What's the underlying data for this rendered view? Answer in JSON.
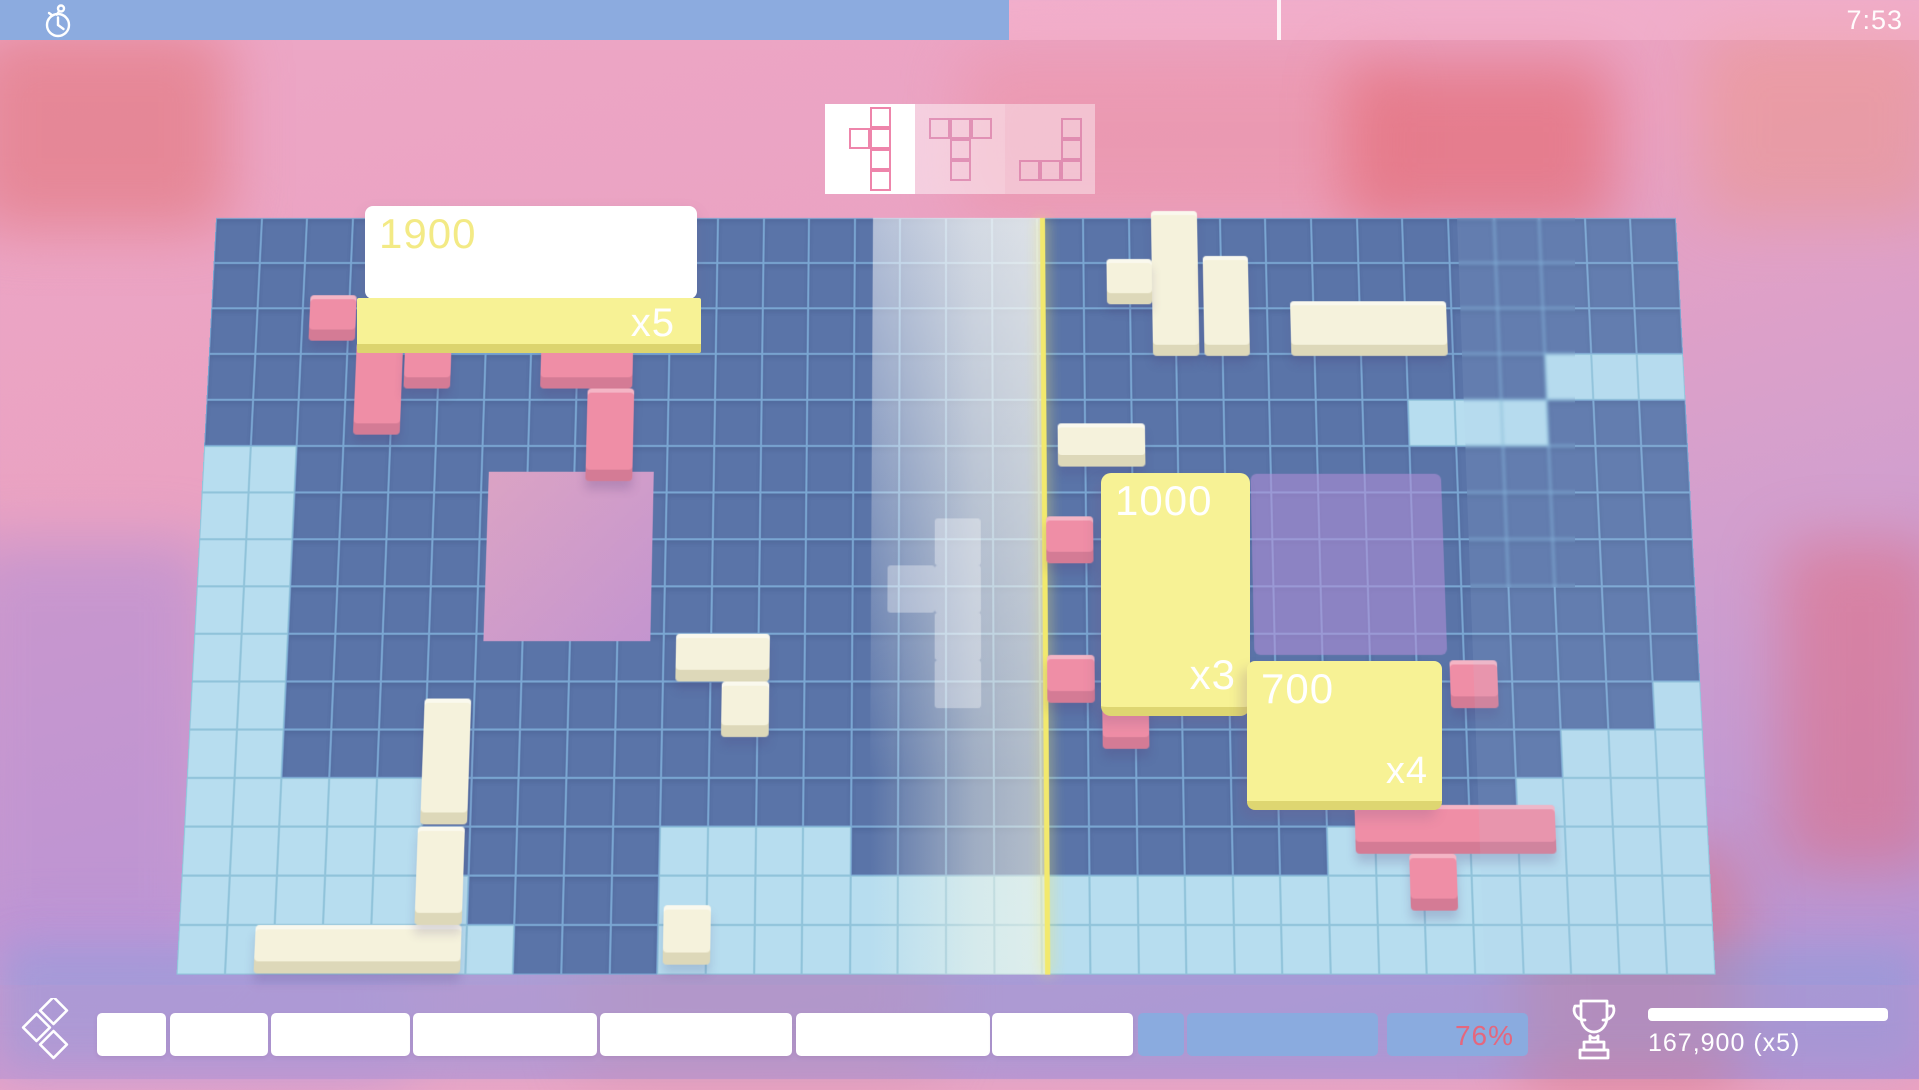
{
  "hud": {
    "time": "7:53",
    "timer": {
      "fill_px": 1009,
      "marker_px": 1277
    }
  },
  "queue": {
    "slots": [
      {
        "id": "current",
        "active": true,
        "piece": "y-pentomino",
        "cells": [
          [
            1,
            0
          ],
          [
            0,
            1
          ],
          [
            1,
            1
          ],
          [
            1,
            2
          ],
          [
            1,
            3
          ]
        ]
      },
      {
        "id": "next-1",
        "active": false,
        "piece": "t-pentomino",
        "cells": [
          [
            0,
            0
          ],
          [
            1,
            0
          ],
          [
            2,
            0
          ],
          [
            1,
            1
          ],
          [
            1,
            2
          ]
        ]
      },
      {
        "id": "next-2",
        "active": false,
        "piece": "j-pentomino",
        "cells": [
          [
            2,
            0
          ],
          [
            2,
            1
          ],
          [
            0,
            2
          ],
          [
            1,
            2
          ],
          [
            2,
            2
          ]
        ]
      }
    ]
  },
  "board": {
    "cols": 32,
    "rows": 16,
    "colors": {
      "dark": "#5a74a8",
      "dark_border": "#7aa6d2",
      "light": "#b7ddef",
      "light_border": "#90c3da",
      "hole": "#cf9ccb",
      "zone": "rgba(178,143,215,0.58)",
      "divider": "#f2e96d",
      "pink": "#ef8ea6",
      "cream": "#f5f2dc",
      "ghost": "rgba(255,255,255,0.34)"
    },
    "light_runs": [
      [
        3,
        29,
        31
      ],
      [
        4,
        26,
        28
      ],
      [
        5,
        0,
        1
      ],
      [
        6,
        0,
        1
      ],
      [
        7,
        0,
        1
      ],
      [
        8,
        0,
        1
      ],
      [
        9,
        0,
        1
      ],
      [
        10,
        0,
        1
      ],
      [
        11,
        0,
        1
      ],
      [
        10,
        31,
        31
      ],
      [
        11,
        29,
        31
      ],
      [
        12,
        0,
        4
      ],
      [
        12,
        28,
        31
      ],
      [
        13,
        0,
        4
      ],
      [
        13,
        10,
        13
      ],
      [
        13,
        24,
        31
      ],
      [
        14,
        0,
        5
      ],
      [
        14,
        10,
        31
      ],
      [
        15,
        0,
        6
      ],
      [
        15,
        10,
        31
      ]
    ],
    "hole": {
      "c": 6.15,
      "r": 5.55,
      "w": 3.55,
      "h": 3.6
    },
    "zone": {
      "c": 22.55,
      "r": 5.6,
      "w": 4.1,
      "h": 3.85
    },
    "divider_col": 18.05,
    "glow": {
      "c1": 14.4,
      "c2": 18.05
    },
    "ghost_cells": [
      [
        15.75,
        6.55
      ],
      [
        14.75,
        7.55
      ],
      [
        15.75,
        7.55
      ],
      [
        15.75,
        8.55
      ],
      [
        15.75,
        9.55
      ]
    ],
    "pieces": [
      {
        "color": "pink",
        "c": 2.15,
        "r": 1.7,
        "w": 1,
        "h": 1
      },
      {
        "color": "pink",
        "c": 3.2,
        "r": 2.75,
        "w": 1,
        "h": 2
      },
      {
        "color": "pink",
        "c": 4.25,
        "r": 2.75,
        "w": 1,
        "h": 1
      },
      {
        "color": "pink",
        "c": 7.2,
        "r": 2.75,
        "w": 2,
        "h": 1
      },
      {
        "color": "pink",
        "c": 8.25,
        "r": 3.75,
        "w": 1,
        "h": 2
      },
      {
        "color": "pink",
        "c": 18.15,
        "r": 6.5,
        "w": 1,
        "h": 1
      },
      {
        "color": "pink",
        "c": 18.15,
        "r": 9.45,
        "w": 1,
        "h": 1
      },
      {
        "color": "pink",
        "c": 19.3,
        "r": 10.4,
        "w": 1,
        "h": 1
      },
      {
        "color": "pink",
        "c": 26.7,
        "r": 9.55,
        "w": 1,
        "h": 1
      },
      {
        "color": "pink",
        "c": 24.6,
        "r": 12.55,
        "w": 4.2,
        "h": 1
      },
      {
        "color": "pink",
        "c": 25.7,
        "r": 13.55,
        "w": 1,
        "h": 1.15
      },
      {
        "color": "cream",
        "c": 4.95,
        "r": 10.35,
        "w": 1,
        "h": 2.6
      },
      {
        "color": "cream",
        "c": 10.25,
        "r": 9.0,
        "w": 2,
        "h": 1
      },
      {
        "color": "cream",
        "c": 11.25,
        "r": 10.0,
        "w": 1,
        "h": 1.15
      },
      {
        "color": "cream",
        "c": 1.6,
        "r": 15.0,
        "w": 4.3,
        "h": 0.98
      },
      {
        "color": "cream",
        "c": 4.9,
        "r": 13.0,
        "w": 1,
        "h": 2
      },
      {
        "color": "cream",
        "c": 10.1,
        "r": 14.6,
        "w": 1,
        "h": 1.2
      },
      {
        "color": "cream",
        "c": 20.5,
        "r": -0.15,
        "w": 1,
        "h": 3.2
      },
      {
        "color": "cream",
        "c": 19.5,
        "r": 0.9,
        "w": 1,
        "h": 1
      },
      {
        "color": "cream",
        "c": 21.6,
        "r": 0.85,
        "w": 1,
        "h": 2.2
      },
      {
        "color": "cream",
        "c": 23.5,
        "r": 1.85,
        "w": 3.4,
        "h": 1.2
      },
      {
        "color": "cream",
        "c": 18.4,
        "r": 4.5,
        "w": 1.9,
        "h": 0.95
      }
    ]
  },
  "score_popups": {
    "clear_1900": {
      "value": "1900",
      "mult": "x5"
    },
    "clear_1000": {
      "value": "1000",
      "mult": "x3"
    },
    "clear_700": {
      "value": "700",
      "mult": "x4"
    }
  },
  "bottom": {
    "percent": "76%",
    "score": "167,900  (x5)",
    "segments": [
      {
        "left": 97,
        "width": 69,
        "state": "filled"
      },
      {
        "left": 170,
        "width": 98,
        "state": "filled"
      },
      {
        "left": 271,
        "width": 139,
        "state": "filled"
      },
      {
        "left": 413,
        "width": 184,
        "state": "filled"
      },
      {
        "left": 600,
        "width": 192,
        "state": "filled"
      },
      {
        "left": 796,
        "width": 194,
        "state": "filled"
      },
      {
        "left": 992,
        "width": 141,
        "state": "filled"
      },
      {
        "left": 1138,
        "width": 46,
        "state": "empty"
      },
      {
        "left": 1187,
        "width": 191,
        "state": "empty"
      },
      {
        "left": 1387,
        "width": 141,
        "state": "empty",
        "label": "76%"
      }
    ]
  }
}
